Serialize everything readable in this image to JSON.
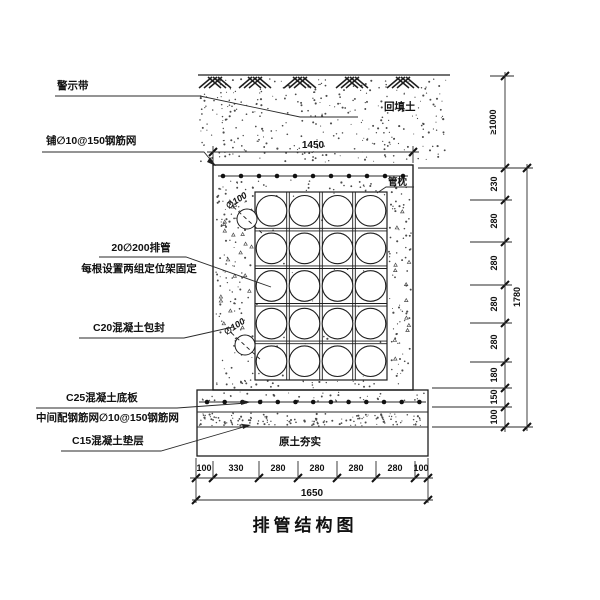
{
  "title": "排管结构图",
  "callouts": {
    "warning_tape": "警示带",
    "top_mesh": "铺∅10@150钢筋网",
    "pipes": "20∅200排管",
    "pipes_note": "每根设置两组定位架固定",
    "encapsulation": "C20混凝土包封",
    "base_slab": "C25混凝土底板",
    "mid_mesh": "中间配钢筋网∅10@150钢筋网",
    "cushion": "C15混凝土垫层",
    "backfill": "回填土",
    "pipe_pillow": "管枕",
    "compacted_soil": "原土夯实",
    "pipe_dia_upper": "∅100",
    "pipe_dia_lower": "∅100"
  },
  "dimensions": {
    "top_width": "1450",
    "bottom_total": "1650",
    "right_total": "1780",
    "cover_depth": "≥1000",
    "right_chain": [
      "230",
      "280",
      "280",
      "280",
      "280",
      "180",
      "150",
      "100"
    ],
    "bottom_chain": [
      "100",
      "330",
      "280",
      "280",
      "280",
      "280",
      "100"
    ]
  },
  "drawing": {
    "pipe_rows": 5,
    "pipe_cols": 4,
    "line_color": "#1e1e1e",
    "stipple_color": "#4a4a4a"
  }
}
